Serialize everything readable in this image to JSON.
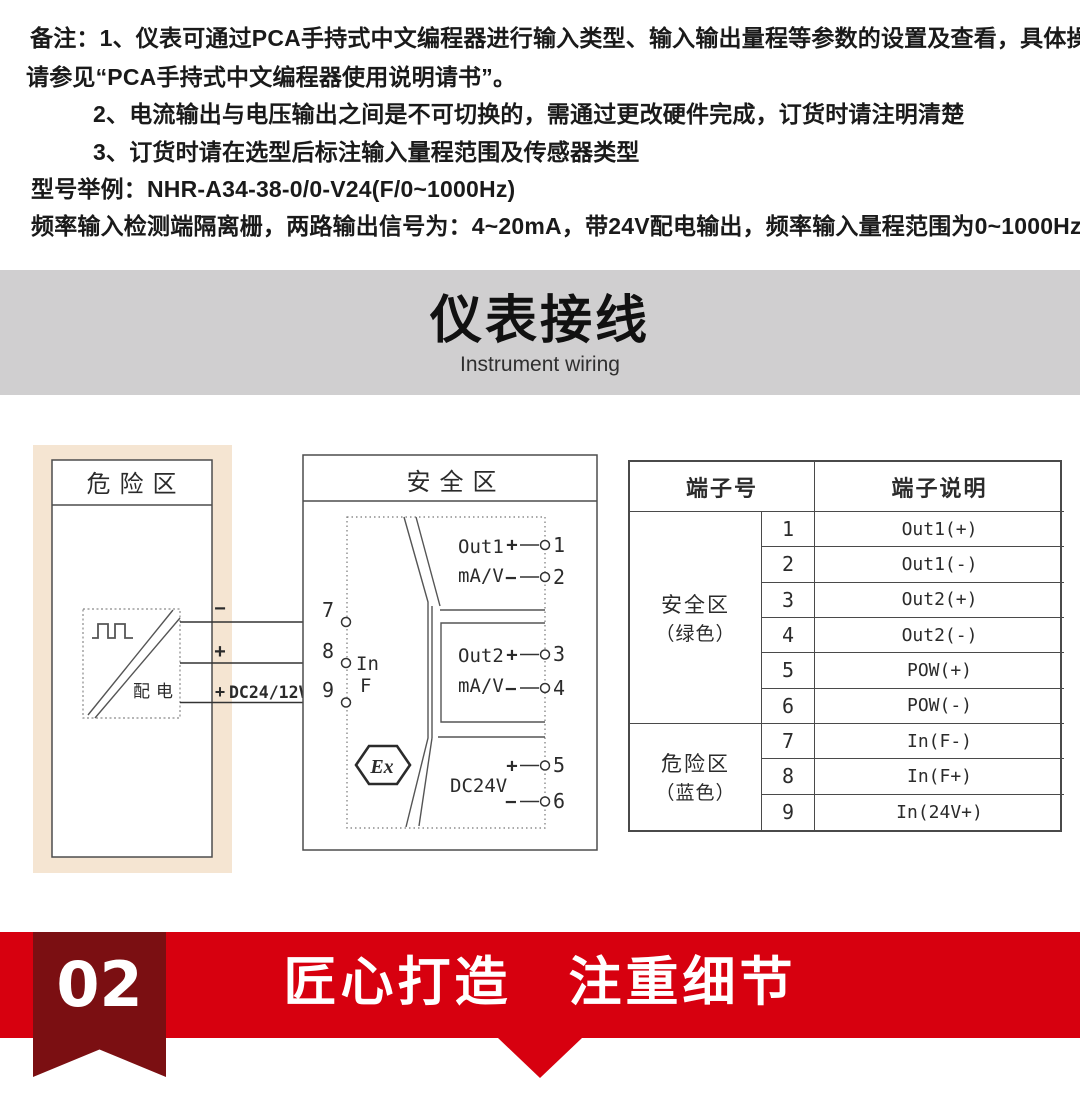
{
  "notes": {
    "lines": [
      "备注：1、仪表可通过PCA手持式中文编程器进行输入类型、输入输出量程等参数的设置及查看，具体操作",
      "请参见“PCA手持式中文编程器使用说明请书”。",
      "2、电流输出与电压输出之间是不可切换的，需通过更改硬件完成，订货时请注明清楚",
      "3、订货时请在选型后标注输入量程范围及传感器类型",
      "型号举例：NHR-A34-38-0/0-V24(F/0~1000Hz)",
      "频率输入检测端隔离栅，两路输出信号为：4~20mA，带24V配电输出，频率输入量程范围为0~1000Hz"
    ]
  },
  "section_banner": {
    "title": "仪表接线",
    "subtitle": "Instrument wiring"
  },
  "diagram": {
    "hazard": {
      "title": "危险区",
      "device_label": "配电",
      "wire_minus": "−",
      "wire_plus": "+",
      "wire3_plus": "+",
      "wire3_label": "DC24/12V"
    },
    "safe": {
      "title": "安全区",
      "ex_mark": "Ex",
      "input_label": "In",
      "input_type": "F",
      "left_terminals": [
        "7",
        "8",
        "9"
      ],
      "plus": "+",
      "minus": "−",
      "out1_name": "Out1",
      "out1_unit": "mA/V",
      "t1": "1",
      "t2": "2",
      "out2_name": "Out2",
      "out2_unit": "mA/V",
      "t3": "3",
      "t4": "4",
      "dc_name": "DC24V",
      "t5": "5",
      "t6": "6"
    }
  },
  "table": {
    "header_no": "端子号",
    "header_desc": "端子说明",
    "group1_name": "安全区",
    "group1_color": "（绿色）",
    "group2_name": "危险区",
    "group2_color": "（蓝色）",
    "rows": [
      {
        "num": "1",
        "desc": "Out1(+)"
      },
      {
        "num": "2",
        "desc": "Out1(-)"
      },
      {
        "num": "3",
        "desc": "Out2(+)"
      },
      {
        "num": "4",
        "desc": "Out2(-)"
      },
      {
        "num": "5",
        "desc": "POW(+)"
      },
      {
        "num": "6",
        "desc": "POW(-)"
      },
      {
        "num": "7",
        "desc": "In(F-)"
      },
      {
        "num": "8",
        "desc": "In(F+)"
      },
      {
        "num": "9",
        "desc": "In(24V+)"
      }
    ]
  },
  "footer": {
    "index": "02",
    "title": "匠心打造　注重细节"
  },
  "colors": {
    "accent_red": "#d7000f",
    "ribbon_dark": "#7b0f12",
    "banner_gray": "#d0cfd0",
    "hazard_beige": "#f5e5d2"
  }
}
